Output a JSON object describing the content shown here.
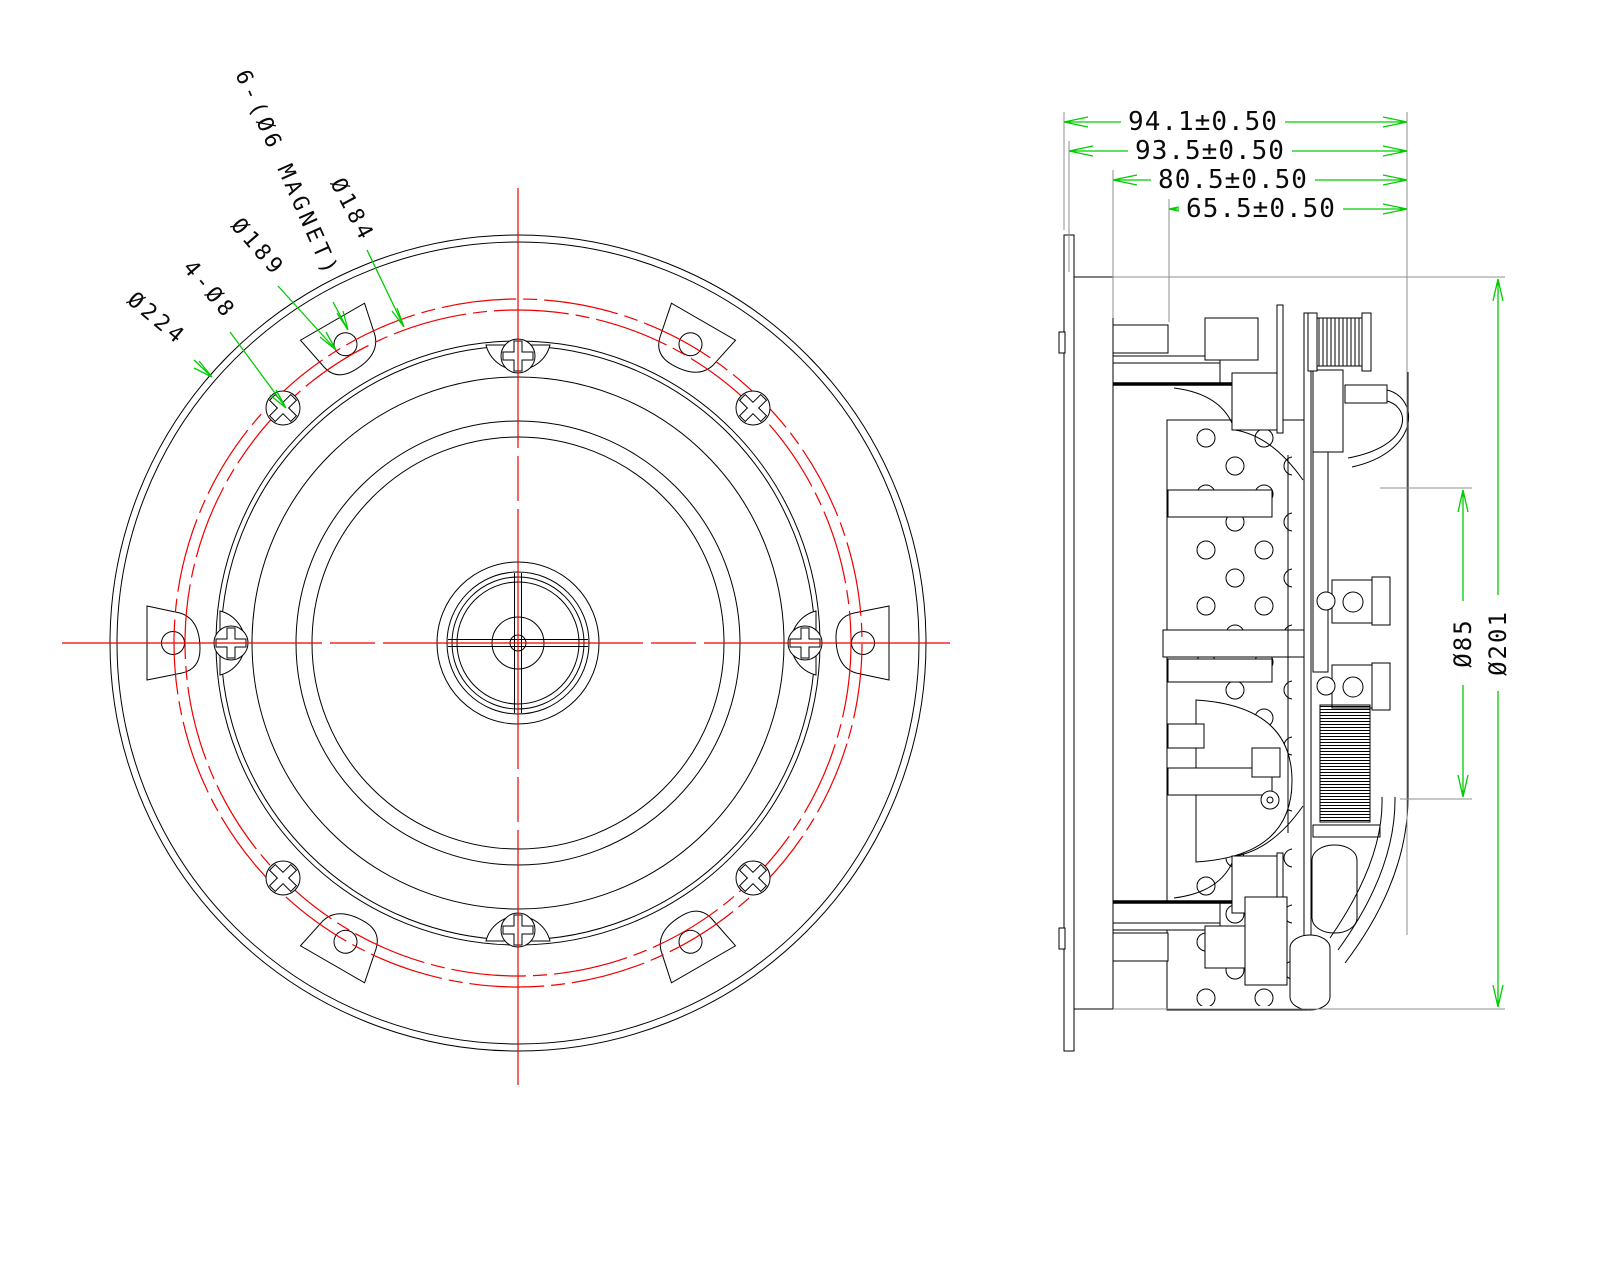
{
  "front_view": {
    "callouts": {
      "outer_diameter": "Ø224",
      "mounting_holes": "4-Ø8",
      "magnet_circle": "Ø189",
      "magnet_note": "6-(Ø6 MAGNET)",
      "screw_circle": "Ø184"
    }
  },
  "side_view": {
    "depth_dims": {
      "d1": "94.1±0.50",
      "d2": "93.5±0.50",
      "d3": "80.5±0.50",
      "d4": "65.5±0.50"
    },
    "dia_dims": {
      "coil": "Ø85",
      "body": "Ø201"
    }
  },
  "colors": {
    "geometry": "#000000",
    "centerline": "#ee0000",
    "dimension": "#00cc00",
    "extension": "#8f8f8f"
  }
}
